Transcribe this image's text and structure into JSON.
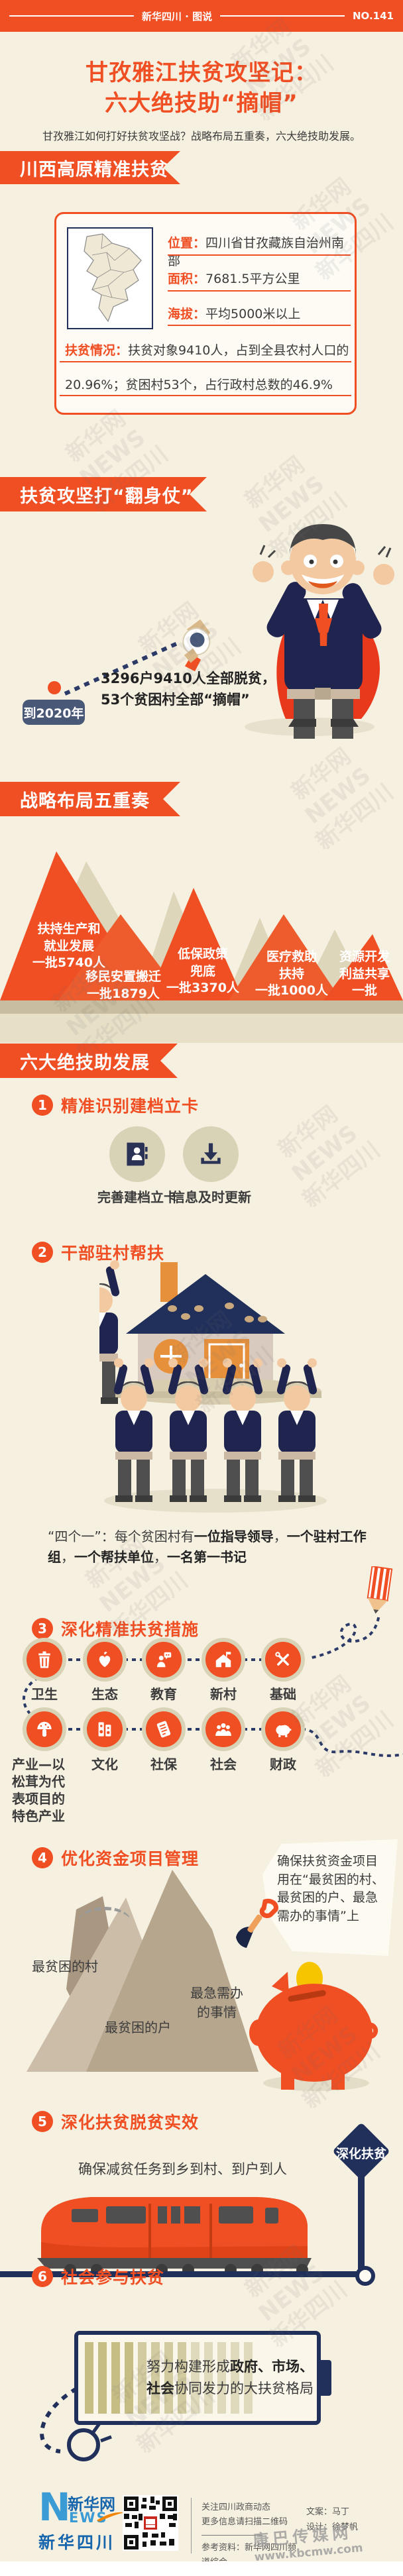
{
  "colors": {
    "accent": "#f04e23",
    "navy": "#20305a",
    "cream": "#f6f0e0",
    "olive": "#d8d3b6",
    "slate_badge": "#4a5878",
    "coin_yellow": "#f6c500"
  },
  "header": {
    "brand": "新华四川 · 图说",
    "issue": "NO.141"
  },
  "title": {
    "line1": "甘孜雅江扶贫攻坚记：",
    "line2": "六大绝技助“摘帽”",
    "subtitle": "甘孜雅江如何打好扶贫攻坚战？战略布局五重奏，六大绝技助发展。"
  },
  "watermark": {
    "text": "新华网 NEWS\n新华四川",
    "site_name": "康巴传媒网",
    "site_url": "www.kbcmw.com"
  },
  "overview": {
    "banner": "川西高原精准扶贫",
    "rows": [
      {
        "label": "位置",
        "value": "四川省甘孜藏族自治州南部"
      },
      {
        "label": "面积",
        "value": "7681.5平方公里"
      },
      {
        "label": "海拔",
        "value": "平均5000米以上"
      }
    ],
    "poverty_label": "扶贫情况",
    "poverty_line1": "扶贫对象9410人，占到全县农村人口的",
    "poverty_line2": "20.96%；贫困村53个，占行政村总数的46.9%"
  },
  "goal": {
    "banner": "扶贫攻坚打“翻身仗”",
    "badge": "到2020年",
    "line1": "3296户9410人全部脱贫，",
    "line2": "53个贫困村全部“摘帽”"
  },
  "strategy": {
    "banner": "战略布局五重奏",
    "peaks": [
      "扶持生产和\n就业发展\n一批5740人",
      "移民安置搬迁\n一批1879人",
      "低保政策\n兜底\n一批3370人",
      "医疗救助\n扶持\n一批1000人",
      "资源开发\n利益共享\n一批"
    ]
  },
  "six": {
    "banner": "六大绝技助发展",
    "m1": {
      "num": "1",
      "title": "精准识别建档立卡",
      "label1": "完善建档立卡",
      "label2": "信息及时更新"
    },
    "m2": {
      "num": "2",
      "title": "干部驻村帮扶",
      "note": [
        "“四个一”：每个贫困村有",
        "一位指导领导",
        "，",
        "一个驻村工作组",
        "，",
        "一个帮扶单位",
        "，",
        "一名第一书记"
      ]
    },
    "m3": {
      "num": "3",
      "title": "深化精准扶贫措施",
      "row1": [
        "卫生",
        "生态",
        "教育",
        "新村",
        "基础"
      ],
      "row2": [
        "产业—以\n松茸为代\n表项目的\n特色产业",
        "文化",
        "社保",
        "社会",
        "财政"
      ]
    },
    "m4": {
      "num": "4",
      "title": "优化资金项目管理",
      "bubble": "确保扶贫资金项目\n用在“最贫困的村、\n最贫困的户、最急\n需办的事情”上",
      "labels": [
        "最贫困的村",
        "最贫困的户",
        "最急需办\n的事情"
      ]
    },
    "m5": {
      "num": "5",
      "title": "深化扶贫脱贫实效",
      "note": "确保减贫任务到乡到村、到户到人",
      "sign": "深化扶贫"
    },
    "m6": {
      "num": "6",
      "title": "社会参与扶贫",
      "battery": [
        "努力构建形成",
        "政府、市场、",
        "社会",
        "协同发力的大扶贫格局"
      ]
    }
  },
  "footer": {
    "logo_n": "N",
    "logo_name": "新华网",
    "logo_news": "EWS",
    "logo_region": "新华四川",
    "qr_note1": "关注四川政商动态",
    "qr_note2": "更多信息请扫描二维码",
    "ref": "参考资料：新华网四川频道综合",
    "credit_text": "文案：马丁",
    "credit_design": "设计：徐梦帆"
  }
}
